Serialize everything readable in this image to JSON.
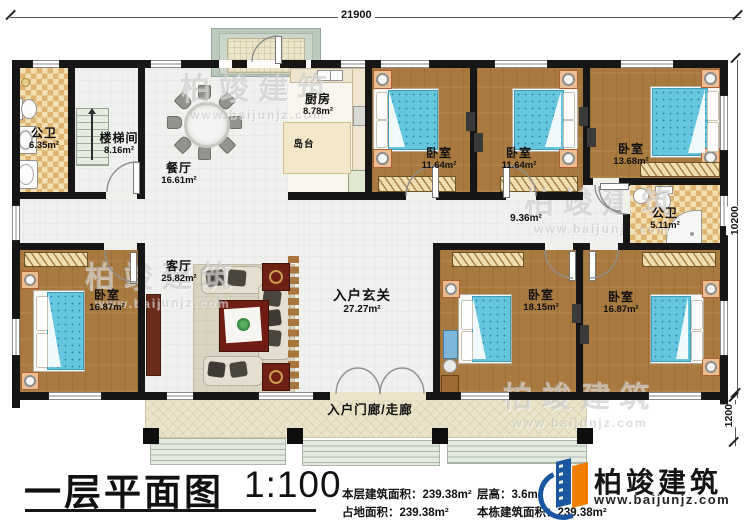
{
  "dimensions": {
    "top_width": "21900",
    "right_height": "10200",
    "porch_depth": "1200"
  },
  "rooms": {
    "bath1": {
      "name": "公卫",
      "area": "6.35m²"
    },
    "stairwell": {
      "name": "楼梯间",
      "area": "8.16m²"
    },
    "dining": {
      "name": "餐厅",
      "area": "16.61m²"
    },
    "kitchen": {
      "name": "厨房",
      "area": "8.78m²"
    },
    "island": {
      "name": "岛台"
    },
    "bedroom_top_1": {
      "name": "卧室",
      "area": "11.64m²"
    },
    "bedroom_top_2": {
      "name": "卧室",
      "area": "11.64m²"
    },
    "bedroom_top_3": {
      "name": "卧室",
      "area": "13.68m²"
    },
    "bath2": {
      "name": "公卫",
      "area": "5.11m²"
    },
    "hallway": {
      "area": "9.36m²"
    },
    "bedroom_bottom_left": {
      "name": "卧室",
      "area": "16.87m²"
    },
    "living": {
      "name": "客厅",
      "area": "25.82m²"
    },
    "foyer": {
      "name": "入户玄关",
      "area": "27.27m²"
    },
    "bedroom_bottom_2": {
      "name": "卧室",
      "area": "18.15m²"
    },
    "bedroom_bottom_3": {
      "name": "卧室",
      "area": "16.87m²"
    },
    "porch": {
      "name": "入户门廊/走廊"
    }
  },
  "titleblock": {
    "title": "一层平面图",
    "scale": "1:100",
    "stats": [
      {
        "label": "本层建筑面积：",
        "value": "239.38m²"
      },
      {
        "label": "占地面积：",
        "value": "239.38m²"
      },
      {
        "label": "层高：",
        "value": "3.6m"
      },
      {
        "label": "本栋建筑面积：",
        "value": "239.38m²"
      }
    ]
  },
  "logo": {
    "name": "柏竣建筑",
    "url": "www.baijunjz.com",
    "brand_blue": "#1a57a0",
    "brand_orange": "#ef7d00"
  },
  "watermark": {
    "name": "柏竣建筑",
    "url": "www.baijunjz.com"
  }
}
